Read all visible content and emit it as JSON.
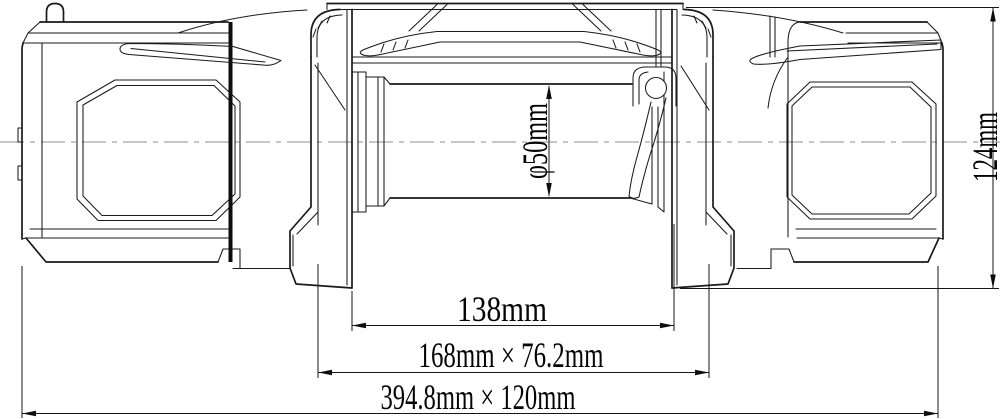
{
  "dimensions": {
    "drum_diameter": "φ50mm",
    "overall_height": "124mm",
    "drum_inner_width": "138mm",
    "mount_bolt_pattern": "168mm × 76.2mm",
    "overall_footprint": "394.8mm × 120mm"
  },
  "colors": {
    "line": "#1a1a1a",
    "background": "#ffffff",
    "centerline": "#8f8f8f"
  }
}
